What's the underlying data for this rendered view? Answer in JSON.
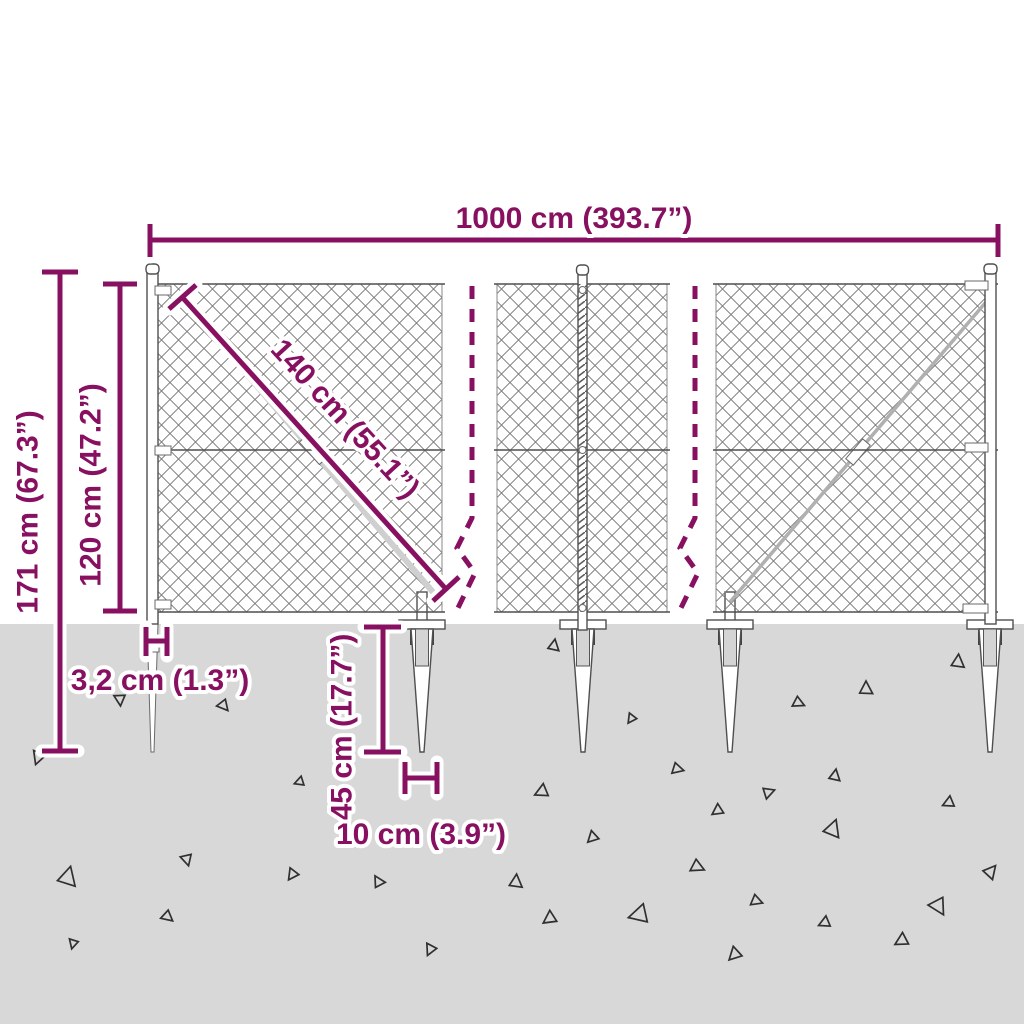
{
  "diagram": {
    "type": "product-dimension-diagram",
    "subject": "chain-link fence with spike anchors",
    "labels": {
      "total_width": "1000 cm (393.7”)",
      "total_height": "171 cm (67.3”)",
      "fence_height": "120 cm (47.2”)",
      "mesh_diagonal": "140 cm (55.1”)",
      "post_width": "3,2 cm (1.3”)",
      "spike_length": "45 cm (17.7”)",
      "anchor_width": "10 cm (3.9”)"
    },
    "colors": {
      "accent": "#881061",
      "ground": "#d8d8d8",
      "structure_line": "#4f4f4f",
      "mesh_line": "#7a7a7a"
    }
  }
}
